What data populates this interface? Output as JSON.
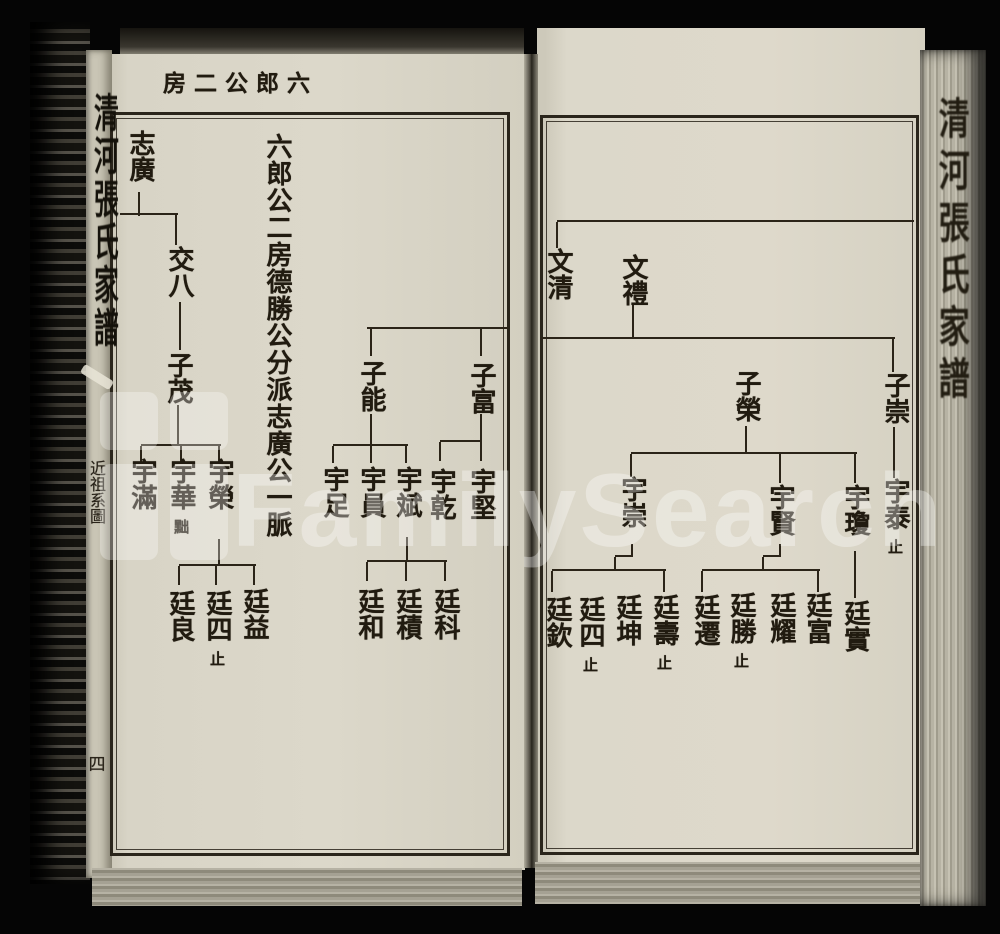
{
  "watermark": {
    "text": "FamilySearch"
  },
  "book": {
    "spine_title": "清河張氏家譜",
    "fore_edge_title": "清河張氏家譜"
  },
  "left_page": {
    "eyebrow": "六郎公二房",
    "intro": "六郎公二房德勝公分派志廣公一脈",
    "margin_label": "近祖系圖",
    "page_number": "四",
    "nodes": [
      {
        "name": "志廣",
        "cx": 140,
        "y": 130
      },
      {
        "name": "交八",
        "cx": 179,
        "y": 246
      },
      {
        "name": "子茂",
        "cx": 178,
        "y": 352
      },
      {
        "name": "宇滿",
        "cx": 142,
        "y": 458
      },
      {
        "name": "宇華",
        "note": "黜",
        "cx": 181,
        "y": 458
      },
      {
        "name": "宇榮",
        "cx": 219,
        "y": 458
      },
      {
        "name": "廷良",
        "cx": 180,
        "y": 590
      },
      {
        "name": "廷四",
        "note": "止",
        "cx": 217,
        "y": 590
      },
      {
        "name": "廷益",
        "cx": 254,
        "y": 588
      },
      {
        "name": "子能",
        "cx": 371,
        "y": 360
      },
      {
        "name": "子富",
        "cx": 481,
        "y": 362
      },
      {
        "name": "宇足",
        "cx": 334,
        "y": 466
      },
      {
        "name": "宇員",
        "cx": 371,
        "y": 466
      },
      {
        "name": "宇斌",
        "cx": 407,
        "y": 466
      },
      {
        "name": "宇乾",
        "cx": 441,
        "y": 468
      },
      {
        "name": "宇堅",
        "cx": 481,
        "y": 468
      },
      {
        "name": "廷和",
        "cx": 369,
        "y": 588
      },
      {
        "name": "廷積",
        "cx": 407,
        "y": 588
      },
      {
        "name": "廷科",
        "cx": 445,
        "y": 588
      }
    ],
    "lines": [
      [
        138,
        192,
        2,
        24
      ],
      [
        120,
        213,
        58,
        2
      ],
      [
        175,
        215,
        2,
        30
      ],
      [
        179,
        302,
        2,
        48
      ],
      [
        177,
        405,
        2,
        41
      ],
      [
        141,
        444,
        80,
        2
      ],
      [
        140,
        446,
        2,
        17
      ],
      [
        180,
        446,
        2,
        17
      ],
      [
        218,
        446,
        2,
        17
      ],
      [
        218,
        539,
        2,
        26
      ],
      [
        179,
        564,
        77,
        2
      ],
      [
        178,
        566,
        2,
        19
      ],
      [
        215,
        566,
        2,
        19
      ],
      [
        253,
        566,
        2,
        19
      ],
      [
        367,
        327,
        141,
        2
      ],
      [
        370,
        329,
        2,
        27
      ],
      [
        480,
        329,
        2,
        27
      ],
      [
        370,
        414,
        2,
        31
      ],
      [
        333,
        444,
        75,
        2
      ],
      [
        332,
        446,
        2,
        17
      ],
      [
        370,
        446,
        2,
        17
      ],
      [
        405,
        446,
        2,
        17
      ],
      [
        480,
        414,
        2,
        27
      ],
      [
        440,
        440,
        42,
        2
      ],
      [
        439,
        442,
        2,
        19
      ],
      [
        480,
        442,
        2,
        19
      ],
      [
        406,
        537,
        2,
        25
      ],
      [
        367,
        560,
        80,
        2
      ],
      [
        366,
        562,
        2,
        19
      ],
      [
        405,
        562,
        2,
        19
      ],
      [
        444,
        562,
        2,
        19
      ]
    ]
  },
  "right_page": {
    "nodes": [
      {
        "name": "文清",
        "cx": 558,
        "y": 248
      },
      {
        "name": "文禮",
        "cx": 633,
        "y": 254
      },
      {
        "name": "子崇",
        "cx": 895,
        "y": 372
      },
      {
        "name": "宇泰",
        "note": "止",
        "cx": 895,
        "y": 478
      },
      {
        "name": "子榮",
        "cx": 746,
        "y": 370
      },
      {
        "name": "宇崇",
        "cx": 632,
        "y": 476
      },
      {
        "name": "宇賢",
        "cx": 780,
        "y": 484
      },
      {
        "name": "宇瓊",
        "cx": 855,
        "y": 484
      },
      {
        "name": "廷實",
        "cx": 855,
        "y": 600
      },
      {
        "name": "廷富",
        "cx": 817,
        "y": 592
      },
      {
        "name": "廷耀",
        "cx": 781,
        "y": 592
      },
      {
        "name": "廷勝",
        "note": "止",
        "cx": 741,
        "y": 592
      },
      {
        "name": "廷遷",
        "cx": 705,
        "y": 594
      },
      {
        "name": "廷壽",
        "note": "止",
        "cx": 664,
        "y": 594
      },
      {
        "name": "廷坤",
        "cx": 627,
        "y": 594
      },
      {
        "name": "廷四",
        "note": "止",
        "cx": 590,
        "y": 596
      },
      {
        "name": "廷欽",
        "cx": 557,
        "y": 596
      }
    ],
    "lines": [
      [
        557,
        220,
        357,
        2
      ],
      [
        556,
        222,
        2,
        26
      ],
      [
        632,
        305,
        2,
        33
      ],
      [
        541,
        337,
        354,
        2
      ],
      [
        892,
        339,
        2,
        33
      ],
      [
        893,
        427,
        2,
        51
      ],
      [
        745,
        426,
        2,
        27
      ],
      [
        631,
        452,
        226,
        2
      ],
      [
        630,
        454,
        2,
        23
      ],
      [
        779,
        454,
        2,
        29
      ],
      [
        854,
        454,
        2,
        29
      ],
      [
        631,
        544,
        2,
        12
      ],
      [
        615,
        555,
        18,
        2
      ],
      [
        614,
        557,
        2,
        13
      ],
      [
        552,
        569,
        114,
        2
      ],
      [
        551,
        571,
        2,
        21
      ],
      [
        663,
        571,
        2,
        21
      ],
      [
        779,
        544,
        2,
        12
      ],
      [
        763,
        555,
        18,
        2
      ],
      [
        762,
        557,
        2,
        13
      ],
      [
        702,
        569,
        118,
        2
      ],
      [
        701,
        571,
        2,
        21
      ],
      [
        817,
        571,
        2,
        21
      ],
      [
        854,
        551,
        2,
        47
      ]
    ]
  }
}
